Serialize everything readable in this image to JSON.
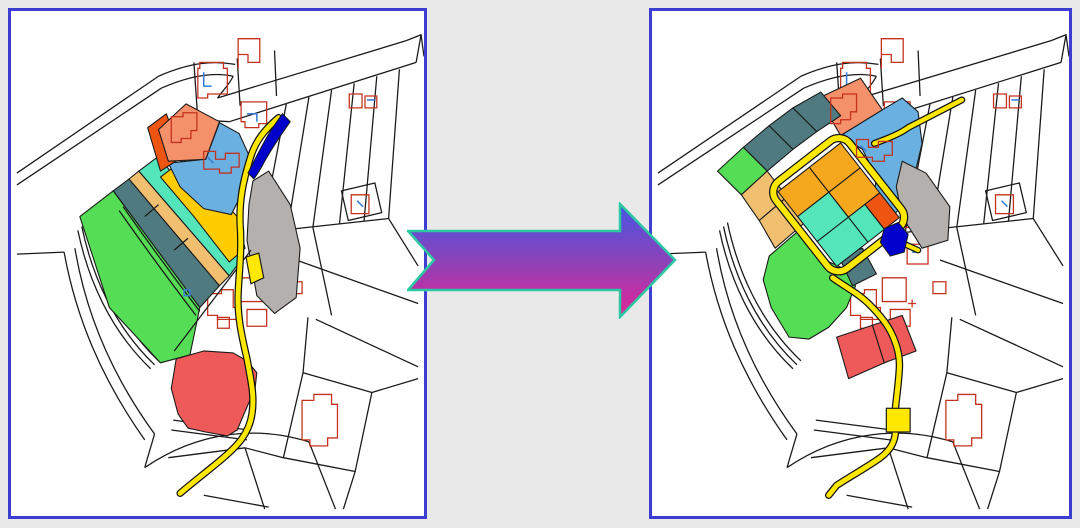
{
  "figure": {
    "type": "before-after-map-comparison",
    "subject": "cadastral parcel maps connected by a transformation arrow",
    "panel_count": 2
  },
  "panels": {
    "left": {
      "role": "before",
      "content": "fragmented strip parcels along a winding yellow road"
    },
    "right": {
      "role": "after",
      "content": "reallocated block parcels around a yellow road loop"
    }
  },
  "arrow": {
    "icon": "right-arrow-icon",
    "direction": "right"
  },
  "colors": {
    "background": "#e9e9e9",
    "panel_border": "#3d3dd1",
    "panel_bg": "#ffffff",
    "map_line": "#1a1a1a",
    "building_outline": "#c3321f",
    "building_accent": "#3b7fd4",
    "road_yellow": "#ffe800",
    "road_casing": "#111111",
    "parcel_green": "#55dd55",
    "parcel_slate": "#4f7a80",
    "parcel_tan": "#f0c070",
    "parcel_turquoise": "#55e5bb",
    "parcel_yellow": "#ffcc00",
    "parcel_orange": "#f5a81e",
    "parcel_orange_red": "#ee5511",
    "parcel_salmon": "#f4906a",
    "parcel_lightblue": "#6ab0e0",
    "parcel_gray": "#b3b0ae",
    "parcel_red": "#ee5a5a",
    "water_blue": "#0000cc",
    "arrow_top": "#4556e2",
    "arrow_mid": "#9340b5",
    "arrow_bottom": "#e62298",
    "arrow_outline": "#2bc8a2"
  }
}
